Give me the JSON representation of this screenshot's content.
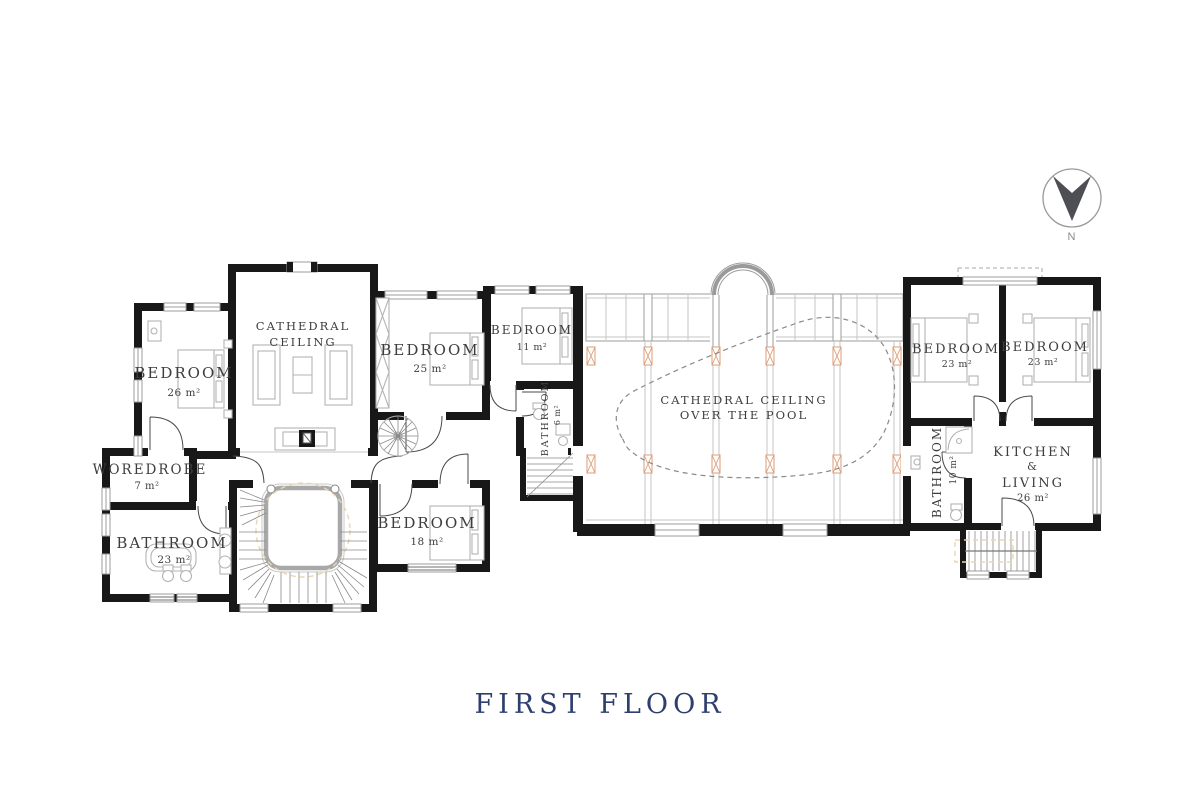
{
  "title": "FIRST FLOOR",
  "compass": {
    "north_label": "N"
  },
  "rooms": {
    "bedroom_26": {
      "name": "BEDROOM",
      "area": "26 m²"
    },
    "cathedral_ceiling": {
      "line1": "CATHEDRAL",
      "line2": "CEILING"
    },
    "bedroom_25": {
      "name": "BEDROOM",
      "area": "25 m²"
    },
    "bedroom_11": {
      "name": "BEDROOM",
      "area": "11 m²"
    },
    "bathroom_6": {
      "name": "BATHROOM",
      "area": "6 m²"
    },
    "wardrobe_7": {
      "name": "WOREDROBE",
      "area": "7 m²"
    },
    "bathroom_23": {
      "name": "BATHROOM",
      "area": "23 m²"
    },
    "bedroom_18": {
      "name": "BEDROOM",
      "area": "18 m²"
    },
    "pool_hall": {
      "line1": "CATHEDRAL CEILING",
      "line2": "OVER THE POOL"
    },
    "bedroom_23_left": {
      "name": "BEDROOM",
      "area": "23 m²"
    },
    "bedroom_23_right": {
      "name": "BEDROOM",
      "area": "23 m²"
    },
    "bathroom_10": {
      "name": "BATHROOM",
      "area": "10 m²"
    },
    "kitchen_living": {
      "line1": "KITCHEN",
      "line2": "&",
      "line3": "LIVING",
      "area": "26 m²"
    }
  },
  "colors": {
    "wall": "#181818",
    "drawing_line": "#9c9c9c",
    "accent_marker": "#dc9d77",
    "title_navy": "#2d3f6e"
  }
}
